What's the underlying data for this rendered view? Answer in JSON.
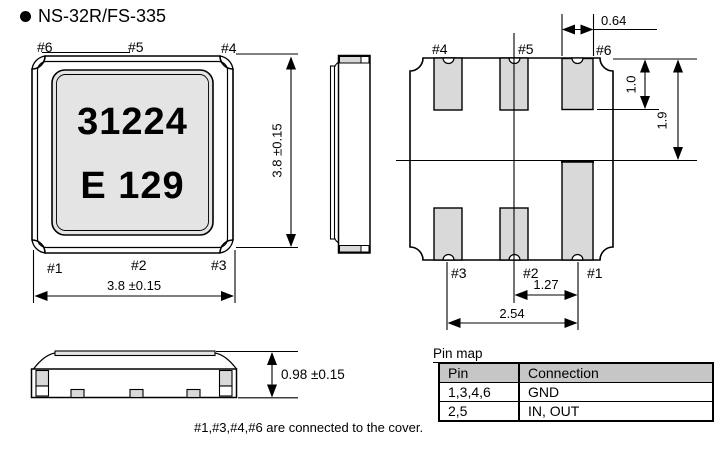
{
  "title": "NS-32R/FS-335",
  "front_view": {
    "marking": {
      "line1": "31224",
      "line2": "E 129"
    },
    "pins": {
      "top_left": "#6",
      "top_center": "#5",
      "top_right": "#4",
      "bottom_left": "#1",
      "bottom_center": "#2",
      "bottom_right": "#3"
    },
    "width_dim": "3.8 ±0.15",
    "height_dim": "3.8 ±0.15"
  },
  "bottom_view": {
    "pins": {
      "top_left": "#4",
      "top_center": "#5",
      "top_right": "#6",
      "bottom_left": "#3",
      "bottom_center": "#2",
      "bottom_right": "#1"
    },
    "pad_width_dim": "0.64",
    "pad_height_dim": "1.0",
    "edge_to_center_dim": "1.9",
    "pitch_dim": "1.27",
    "span_dim": "2.54"
  },
  "side_elevation": {
    "height_dim": "0.98 ±0.15"
  },
  "pin_map": {
    "caption": "Pin map",
    "headers": [
      "Pin",
      "Connection"
    ],
    "rows": [
      [
        "1,3,4,6",
        "GND"
      ],
      [
        "2,5",
        "IN, OUT"
      ]
    ]
  },
  "note": "#1,#3,#4,#6 are connected to the cover.",
  "colors": {
    "line": "#000000",
    "pad_fill": "#d9d9d9",
    "lid_fill": "#e4e4e5",
    "header_fill": "#c6c6c6"
  }
}
